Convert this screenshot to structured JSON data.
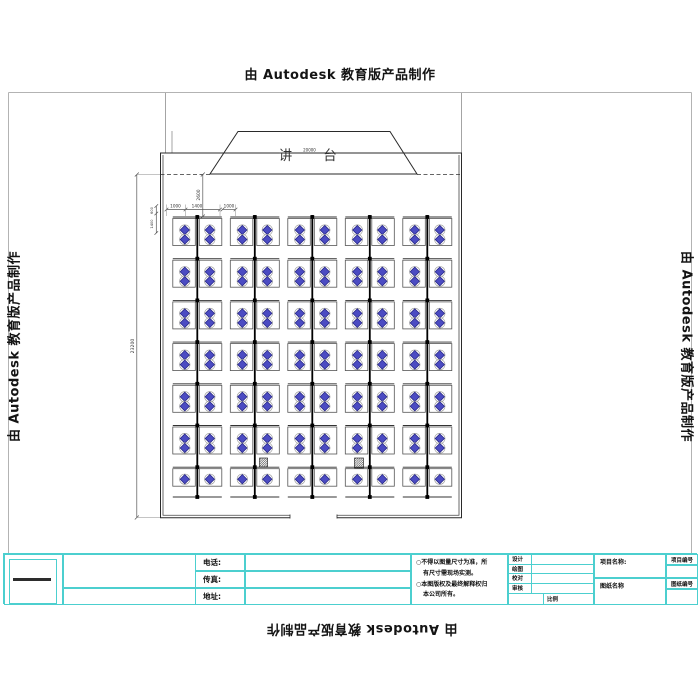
{
  "watermark": {
    "text": "由 Autodesk 教育版产品制作"
  },
  "drawing": {
    "podium": {
      "left_char": "讲",
      "right_char": "台",
      "width_dim": "20000"
    },
    "dims": {
      "stage_offset": "2600",
      "aisle_left": "1000",
      "desk_width": "1400",
      "aisle_mid": "1000",
      "edge_a": "600",
      "edge_b": "1400",
      "room_depth": "23200"
    },
    "grid": {
      "columns": 5,
      "rows_full": 6,
      "rows_half": 1,
      "x0": 197.3,
      "dx": 57.5,
      "y0": 217,
      "row_h": 41.7,
      "y_end": 497,
      "chair_fill": "#4b4bc2",
      "chair_stroke": "#22227e"
    }
  },
  "title_block": {
    "contact": {
      "phone_label": "电话:",
      "fax_label": "传真:",
      "address_label": "地址:"
    },
    "notes": {
      "line1": "○不得以图量尺寸为准，所",
      "line2": "有尺寸需现场实测。",
      "line3": "○本图版权及最终解释权归",
      "line4": "本公司所有。"
    },
    "sign_rows": {
      "r1": "设计",
      "r2": "绘图",
      "r3": "校对",
      "r4": "审核"
    },
    "scale_label": "比例",
    "project_name_label": "项目名称:",
    "project_no_label": "项目编号",
    "sheet_name_label": "图纸名称",
    "sheet_no_label": "图纸编号"
  },
  "colors": {
    "accent_cyan": "#4ccfcf",
    "chair_blue": "#4b4bc2",
    "line_black": "#222222"
  }
}
